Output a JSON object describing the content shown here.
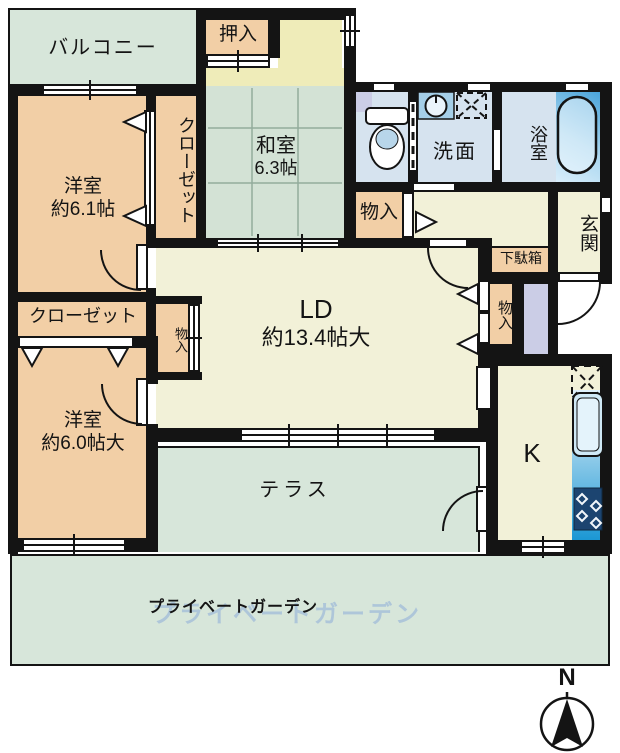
{
  "plan": {
    "rooms": {
      "balcony": {
        "label": "バルコニー"
      },
      "oshiire": {
        "label": "押入"
      },
      "washitsu": {
        "label": "和室",
        "size": "6.3帖"
      },
      "bedroom1": {
        "label": "洋室",
        "size": "約6.1帖"
      },
      "closet1": {
        "label": "クローゼット"
      },
      "washroom": {
        "label": "洗面"
      },
      "bathroom": {
        "label": "浴室"
      },
      "genkan": {
        "label": "玄関"
      },
      "getabako": {
        "label": "下駄箱"
      },
      "storage_hall": {
        "label": "物入"
      },
      "storage_right": {
        "label": "物入"
      },
      "storage_left": {
        "label": "物入"
      },
      "living": {
        "label": "LD",
        "size": "約13.4帖大"
      },
      "closet2": {
        "label": "クローゼット"
      },
      "bedroom2": {
        "label": "洋室",
        "size": "約6.0帖大"
      },
      "kitchen": {
        "label": "K"
      },
      "terrace": {
        "label": "テラス"
      },
      "garden": {
        "label": "プライベートガーデン"
      }
    },
    "watermark": "プライベートガーデン",
    "compass": {
      "label": "N"
    },
    "colors": {
      "wall": "#141414",
      "room_peach": "#f2cfa6",
      "room_green": "#d7e6da",
      "tatami_green": "#d3e2d5",
      "room_cream": "#f2f1d8",
      "room_yellow": "#efecb9",
      "water_blue": "#d6e3ef",
      "pipe_lavender": "#cbcde6",
      "bath_gradient": "#4aa4da",
      "counter_gradient": "#1b97d4"
    }
  }
}
